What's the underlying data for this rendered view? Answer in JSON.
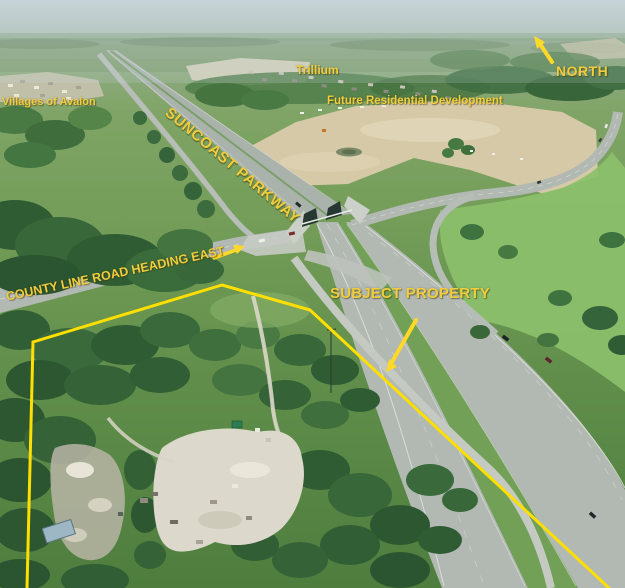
{
  "title": "Annotated aerial photograph of subject property at the Suncoast Parkway and County Line Road interchange",
  "labels": {
    "villages_of_avalon": "Villages of Avalon",
    "trillium": "Trillium",
    "future_residential_development": "Future Residential Development",
    "north": "NORTH",
    "suncoast_parkway": "SUNCOAST PARKWAY",
    "county_line_road": "COUNTY LINE ROAD HEADING EAST",
    "subject_property": "SUBJECT PROPERTY"
  },
  "colors": {
    "annotation_text": "#f0cd3e",
    "boundary_line": "#ffdf00",
    "arrow": "#ffd928"
  }
}
